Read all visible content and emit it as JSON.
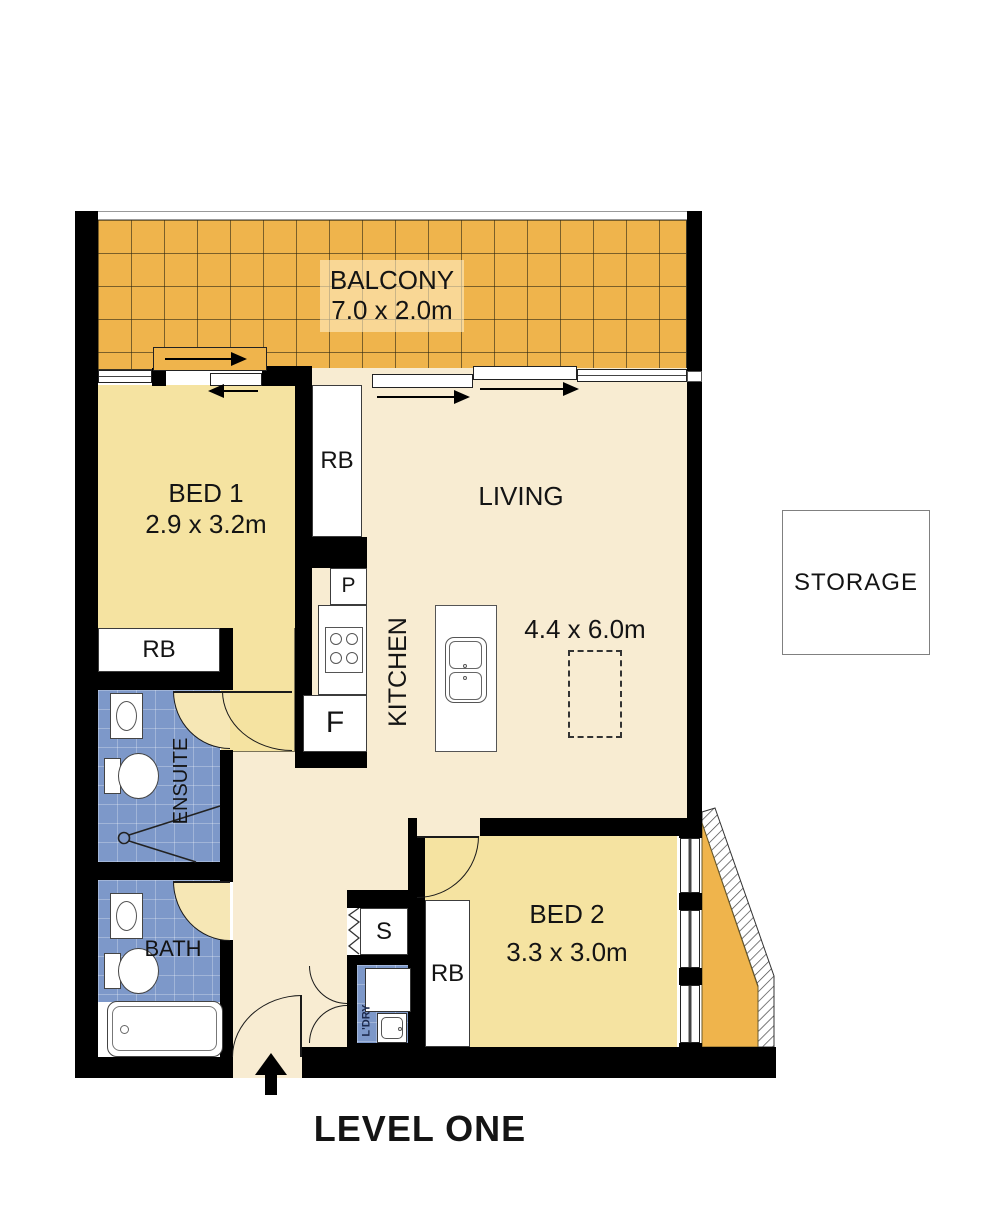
{
  "plan": {
    "title": "LEVEL ONE"
  },
  "rooms": {
    "balcony": {
      "name": "BALCONY",
      "dims": "7.0 x 2.0m"
    },
    "bed1": {
      "name": "BED 1",
      "dims": "2.9 x 3.2m"
    },
    "living": {
      "name": "LIVING",
      "dims": "4.4 x 6.0m"
    },
    "kitchen": {
      "name": "KITCHEN"
    },
    "storage": {
      "name": "STORAGE"
    },
    "ensuite": {
      "name": "ENSUITE"
    },
    "bath": {
      "name": "BATH"
    },
    "bed2": {
      "name": "BED 2",
      "dims": "3.3 x 3.0m"
    },
    "laundry": {
      "name": "L'DRY"
    }
  },
  "fixtures": {
    "robe": "RB",
    "pantry": "P",
    "fridge": "F",
    "cupboard": "S"
  },
  "colors": {
    "balcony_tile": "#EFB44C",
    "bedroom_fill": "#F5E3A1",
    "living_fill": "#F8ECD2",
    "wet_area_fill": "#7D98C9",
    "wall": "#000000"
  }
}
